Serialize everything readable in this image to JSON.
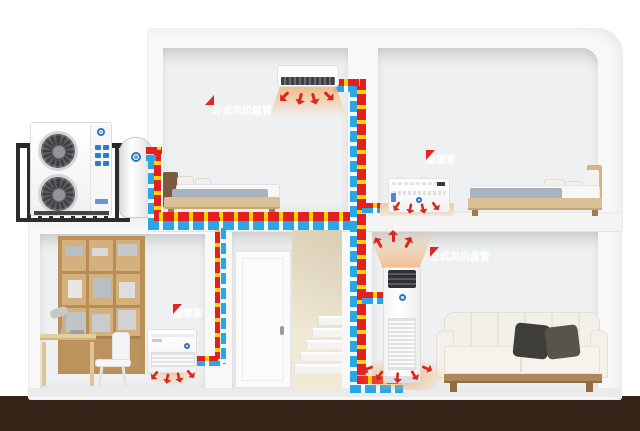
{
  "scene": {
    "type": "air-source heat pump home heating cutaway diagram",
    "callouts": {
      "ceiling_fan_coil": "卧式风机盘管",
      "bedroom_console": "温暖家",
      "study_console": "温暖家",
      "floor_fan_coil": "立式风机盘管"
    },
    "colors": {
      "supply_pipe": "#e41f1f",
      "return_pipe": "#27a7e8",
      "flow_arrow_yellow": "#ffd400",
      "callout_red": "#e62424",
      "warm_air_orange": "#f2ba82",
      "hot_arrow_red": "#d8281e",
      "ground_brown": "#382318",
      "wood": "#c49a62"
    }
  }
}
